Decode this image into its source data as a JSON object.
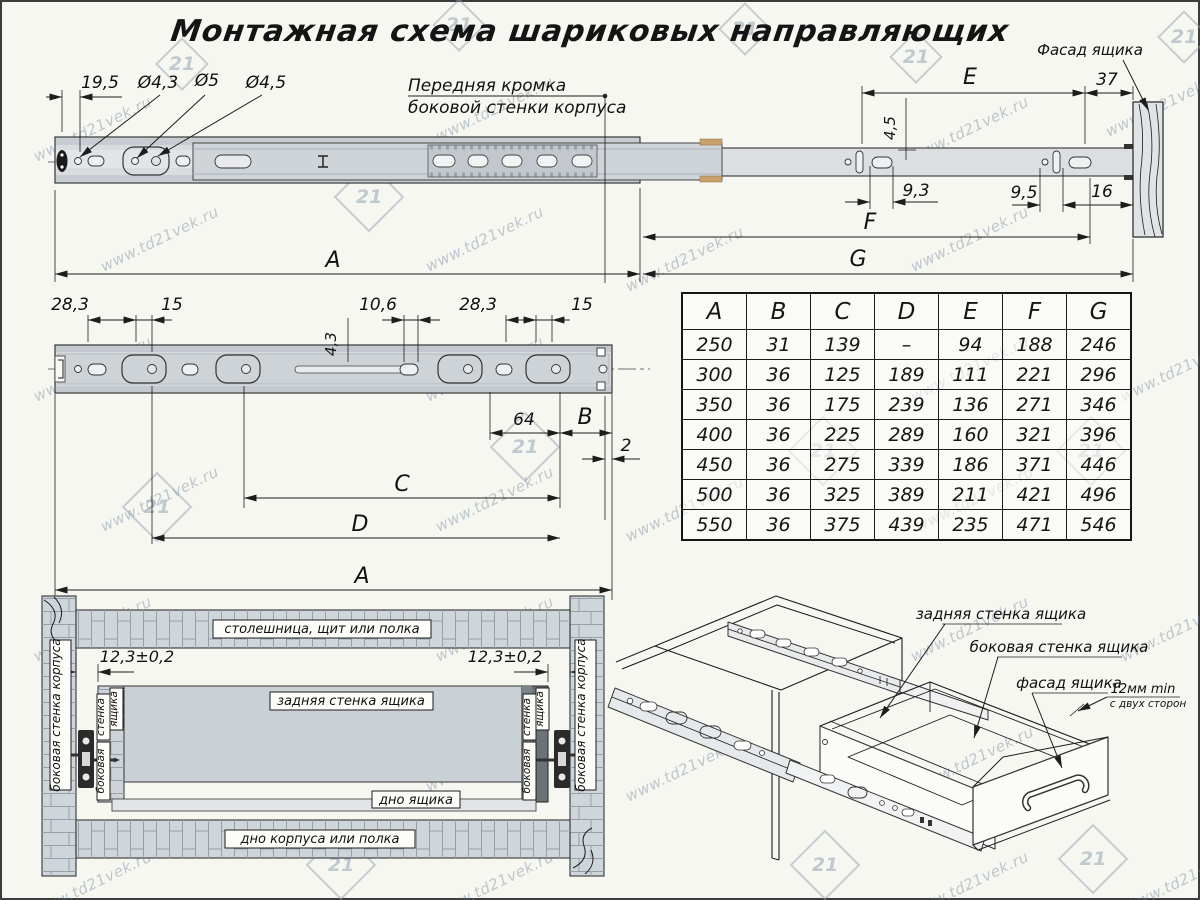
{
  "title": "Монтажная схема шариковых направляющих",
  "watermark": {
    "text": "www.td21vek.ru",
    "logo": "21"
  },
  "top_view": {
    "dim_19_5": "19,5",
    "dim_d4_3": "Ø4,3",
    "dim_d5": "Ø5",
    "dim_d4_5": "Ø4,5",
    "front_edge_line1": "Передняя кромка",
    "front_edge_line2": "боковой стенки корпуса",
    "facade_label": "Фасад ящика",
    "dim_E": "E",
    "dim_37": "37",
    "dim_4_5": "4,5",
    "dim_9_3": "9,3",
    "dim_9_5": "9,5",
    "dim_16": "16",
    "dim_F": "F",
    "dim_G": "G",
    "dim_A": "A"
  },
  "profile_view": {
    "dim_28_3_left": "28,3",
    "dim_15_left": "15",
    "dim_10_6": "10,6",
    "dim_4_3": "4,3",
    "dim_28_3_right": "28,3",
    "dim_15_right": "15",
    "dim_64": "64",
    "dim_B": "B",
    "dim_2": "2",
    "dim_C": "C",
    "dim_D": "D",
    "dim_A": "A"
  },
  "size_table": {
    "headers": [
      "A",
      "B",
      "C",
      "D",
      "E",
      "F",
      "G"
    ],
    "rows": [
      [
        "250",
        "31",
        "139",
        "–",
        "94",
        "188",
        "246"
      ],
      [
        "300",
        "36",
        "125",
        "189",
        "111",
        "221",
        "296"
      ],
      [
        "350",
        "36",
        "175",
        "239",
        "136",
        "271",
        "346"
      ],
      [
        "400",
        "36",
        "225",
        "289",
        "160",
        "321",
        "396"
      ],
      [
        "450",
        "36",
        "275",
        "339",
        "186",
        "371",
        "446"
      ],
      [
        "500",
        "36",
        "325",
        "389",
        "211",
        "421",
        "496"
      ],
      [
        "550",
        "36",
        "375",
        "439",
        "235",
        "471",
        "546"
      ]
    ]
  },
  "section_view": {
    "top_panel": "столешница, щит или полка",
    "body_side": "боковая стенка корпуса",
    "tolerance": "12,3±0,2",
    "rear_wall": "задняя стенка ящика",
    "drawer_bottom": "дно ящика",
    "body_bottom": "дно корпуса или полка",
    "drawer_side_word1": "боковая",
    "drawer_side_word2": "стенка",
    "drawer_side_word3": "ящика"
  },
  "iso_view": {
    "rear_wall": "задняя стенка ящика",
    "side_wall": "боковая стенка ящика",
    "facade": "фасад ящика",
    "gap_line1": "12мм min",
    "gap_line2": "с двух сторон"
  }
}
